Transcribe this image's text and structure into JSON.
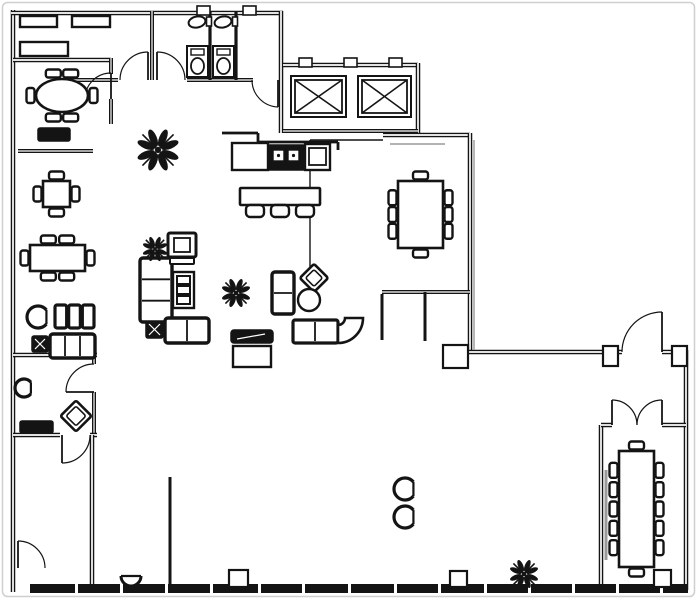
{
  "meta": {
    "title": "Office floor plan drawing",
    "canvas": {
      "w": 697,
      "h": 599
    }
  },
  "palette": {
    "ink": "#141414",
    "paper": "#ffffff",
    "shadow": "#9a9a9a",
    "frame": "#cfcfcf"
  },
  "walls": [
    {
      "pts": [
        [
          13,
          10
        ],
        [
          13,
          592
        ]
      ],
      "t": 4.5,
      "style": "double"
    },
    {
      "pts": [
        [
          11,
          13
        ],
        [
          283,
          13
        ]
      ],
      "t": 4.5,
      "style": "double"
    },
    {
      "pts": [
        [
          152,
          11
        ],
        [
          152,
          80
        ]
      ],
      "t": 4,
      "style": "double"
    },
    {
      "pts": [
        [
          70,
          80
        ],
        [
          118,
          80
        ]
      ],
      "t": 4,
      "style": "double"
    },
    {
      "pts": [
        [
          187,
          80
        ],
        [
          253,
          80
        ]
      ],
      "t": 4,
      "style": "double"
    },
    {
      "pts": [
        [
          281,
          11
        ],
        [
          281,
          133
        ]
      ],
      "t": 4.5,
      "style": "double"
    },
    {
      "pts": [
        [
          210,
          11
        ],
        [
          210,
          80
        ]
      ],
      "t": 3.2,
      "style": "solid"
    },
    {
      "pts": [
        [
          236,
          11
        ],
        [
          236,
          80
        ]
      ],
      "t": 3.2,
      "style": "solid"
    },
    {
      "pts": [
        [
          13,
          60
        ],
        [
          111,
          60
        ]
      ],
      "t": 4.5,
      "style": "double"
    },
    {
      "pts": [
        [
          111,
          58
        ],
        [
          111,
          74
        ]
      ],
      "t": 4,
      "style": "double"
    },
    {
      "pts": [
        [
          111,
          99
        ],
        [
          111,
          124
        ]
      ],
      "t": 4,
      "style": "double"
    },
    {
      "pts": [
        [
          18,
          151
        ],
        [
          93,
          151
        ]
      ],
      "t": 4,
      "style": "double"
    },
    {
      "pts": [
        [
          283,
          65
        ],
        [
          418,
          65
        ]
      ],
      "t": 4.5,
      "style": "double"
    },
    {
      "pts": [
        [
          418,
          63
        ],
        [
          418,
          133
        ]
      ],
      "t": 4.5,
      "style": "double"
    },
    {
      "pts": [
        [
          283,
          131
        ],
        [
          418,
          131
        ]
      ],
      "t": 4,
      "style": "double"
    },
    {
      "pts": [
        [
          222,
          133
        ],
        [
          258,
          133
        ]
      ],
      "t": 2.8,
      "style": "solid"
    },
    {
      "pts": [
        [
          258,
          133
        ],
        [
          258,
          142
        ]
      ],
      "t": 2.8,
      "style": "solid"
    },
    {
      "pts": [
        [
          258,
          142
        ],
        [
          338,
          142
        ]
      ],
      "t": 2.8,
      "style": "solid"
    },
    {
      "pts": [
        [
          338,
          142
        ],
        [
          338,
          150
        ]
      ],
      "t": 2.8,
      "style": "solid"
    },
    {
      "pts": [
        [
          383,
          135
        ],
        [
          470,
          135
        ]
      ],
      "t": 4.5,
      "style": "double"
    },
    {
      "pts": [
        [
          310,
          140
        ],
        [
          383,
          140
        ]
      ],
      "t": 1.4,
      "style": "thin"
    },
    {
      "pts": [
        [
          310,
          140
        ],
        [
          310,
          292
        ]
      ],
      "t": 1.4,
      "style": "thin"
    },
    {
      "pts": [
        [
          470,
          133
        ],
        [
          470,
          352
        ]
      ],
      "t": 4.5,
      "style": "double"
    },
    {
      "pts": [
        [
          382,
          292
        ],
        [
          470,
          292
        ]
      ],
      "t": 4,
      "style": "double"
    },
    {
      "pts": [
        [
          425,
          292
        ],
        [
          425,
          341
        ]
      ],
      "t": 3,
      "style": "solid"
    },
    {
      "pts": [
        [
          382,
          294
        ],
        [
          382,
          340
        ]
      ],
      "t": 3,
      "style": "solid"
    },
    {
      "pts": [
        [
          443,
          352
        ],
        [
          622,
          352
        ]
      ],
      "t": 4.5,
      "style": "double"
    },
    {
      "pts": [
        [
          662,
          352
        ],
        [
          686,
          352
        ]
      ],
      "t": 4.5,
      "style": "double"
    },
    {
      "pts": [
        [
          686,
          350
        ],
        [
          686,
          590
        ]
      ],
      "t": 4.5,
      "style": "double"
    },
    {
      "pts": [
        [
          13,
          355
        ],
        [
          97,
          355
        ]
      ],
      "t": 4.5,
      "style": "double"
    },
    {
      "pts": [
        [
          94,
          355
        ],
        [
          94,
          364
        ]
      ],
      "t": 4,
      "style": "double"
    },
    {
      "pts": [
        [
          94,
          392
        ],
        [
          94,
          435
        ]
      ],
      "t": 4,
      "style": "double"
    },
    {
      "pts": [
        [
          13,
          435
        ],
        [
          60,
          435
        ]
      ],
      "t": 4.5,
      "style": "double"
    },
    {
      "pts": [
        [
          90,
          435
        ],
        [
          97,
          435
        ]
      ],
      "t": 4.5,
      "style": "double"
    },
    {
      "pts": [
        [
          92,
          435
        ],
        [
          92,
          588
        ]
      ],
      "t": 4.5,
      "style": "double"
    },
    {
      "pts": [
        [
          170,
          477
        ],
        [
          170,
          586
        ]
      ],
      "t": 3,
      "style": "solid"
    },
    {
      "pts": [
        [
          601,
          425
        ],
        [
          601,
          586
        ]
      ],
      "t": 4.5,
      "style": "double"
    },
    {
      "pts": [
        [
          601,
          425
        ],
        [
          612,
          425
        ]
      ],
      "t": 4.5,
      "style": "double"
    },
    {
      "pts": [
        [
          662,
          425
        ],
        [
          686,
          425
        ]
      ],
      "t": 4.5,
      "style": "double"
    },
    {
      "pts": [
        [
          474,
          140
        ],
        [
          474,
          350
        ]
      ],
      "t": 1.4,
      "style": "gray"
    },
    {
      "pts": [
        [
          390,
          144
        ],
        [
          445,
          144
        ]
      ],
      "t": 1.4,
      "style": "gray"
    },
    {
      "pts": [
        [
          606,
          470
        ],
        [
          606,
          560
        ]
      ],
      "t": 3,
      "style": "gray"
    }
  ],
  "doors": [
    {
      "name": "vestibule-door-left",
      "hinge": [
        148,
        80
      ],
      "tip": [
        148,
        52
      ],
      "end": [
        120,
        80
      ],
      "sweep": 0
    },
    {
      "name": "vestibule-door-right",
      "hinge": [
        157,
        80
      ],
      "tip": [
        157,
        52
      ],
      "end": [
        185,
        80
      ],
      "sweep": 1
    },
    {
      "name": "corridor-door",
      "hinge": [
        278,
        80
      ],
      "tip": [
        278,
        107
      ],
      "end": [
        252,
        80
      ],
      "sweep": 1
    },
    {
      "name": "meeting-room-door",
      "hinge": [
        111,
        99
      ],
      "tip": [
        111,
        73
      ],
      "end": [
        85,
        99
      ],
      "sweep": 0
    },
    {
      "name": "office-door",
      "hinge": [
        94,
        392
      ],
      "tip": [
        66,
        392
      ],
      "end": [
        94,
        364
      ],
      "sweep": 1
    },
    {
      "name": "stairwell-door",
      "hinge": [
        62,
        435
      ],
      "tip": [
        62,
        463
      ],
      "end": [
        90,
        435
      ],
      "sweep": 0
    },
    {
      "name": "stair-exit-door",
      "hinge": [
        18,
        568
      ],
      "tip": [
        18,
        541
      ],
      "end": [
        45,
        568
      ],
      "sweep": 1
    },
    {
      "name": "entry-door-right",
      "hinge": [
        662,
        352
      ],
      "tip": [
        662,
        312
      ],
      "end": [
        622,
        352
      ],
      "sweep": 0
    },
    {
      "name": "boardroom-door-left",
      "hinge": [
        612,
        425
      ],
      "tip": [
        612,
        400
      ],
      "end": [
        637,
        425
      ],
      "sweep": 1
    },
    {
      "name": "boardroom-door-right",
      "hinge": [
        662,
        425
      ],
      "tip": [
        662,
        400
      ],
      "end": [
        637,
        425
      ],
      "sweep": 0
    }
  ],
  "columns": [
    [
      443,
      345,
      25,
      23
    ],
    [
      603,
      346,
      15,
      20
    ],
    [
      672,
      346,
      15,
      20
    ],
    [
      229,
      570,
      19,
      17
    ],
    [
      450,
      571,
      17,
      16
    ],
    [
      654,
      570,
      17,
      17
    ]
  ],
  "wall_ticks": [
    [
      197,
      6,
      13,
      9
    ],
    [
      243,
      6,
      13,
      9
    ],
    [
      299,
      58,
      13,
      9
    ],
    [
      344,
      58,
      13,
      9
    ],
    [
      389,
      58,
      13,
      9
    ]
  ],
  "bottom_band": {
    "x1": 30,
    "x2": 688,
    "y": 584,
    "h": 9,
    "ticks": [
      75,
      120,
      165,
      210,
      258,
      302,
      348,
      394,
      438,
      484,
      528,
      572,
      616,
      660
    ]
  },
  "furniture": {
    "cabinets": [
      [
        20,
        16,
        37,
        11
      ],
      [
        72,
        16,
        38,
        11
      ],
      [
        20,
        42,
        48,
        14
      ],
      [
        233,
        346,
        38,
        21
      ]
    ],
    "credenzas": [
      [
        38,
        128,
        32,
        13
      ],
      [
        20,
        421,
        33,
        12
      ]
    ],
    "tv_console": [
      231,
      330,
      42,
      13
    ],
    "x_tables": [
      [
        146,
        321,
        17,
        17
      ],
      [
        32,
        336,
        16,
        16
      ]
    ],
    "tables": [
      {
        "name": "oval-meeting-table",
        "shape": "oval",
        "x": 36,
        "y": 79,
        "w": 52,
        "h": 33,
        "chairs": {
          "top": 2,
          "bottom": 2,
          "left": 1,
          "right": 1
        }
      },
      {
        "name": "cafe-table",
        "shape": "rect",
        "x": 43,
        "y": 181,
        "w": 27,
        "h": 26,
        "chairs": {
          "top": 1,
          "bottom": 1,
          "left": 1,
          "right": 1
        }
      },
      {
        "name": "dining-table",
        "shape": "rect",
        "x": 30,
        "y": 245,
        "w": 55,
        "h": 26,
        "chairs": {
          "top": 2,
          "bottom": 2,
          "left": 1,
          "right": 1
        }
      },
      {
        "name": "conference-table-8",
        "shape": "rect",
        "x": 398,
        "y": 181,
        "w": 45,
        "h": 67,
        "chairs": {
          "top": 1,
          "bottom": 1,
          "left": 3,
          "right": 3
        }
      },
      {
        "name": "boardroom-table-12",
        "shape": "rect",
        "x": 619,
        "y": 451,
        "w": 35,
        "h": 116,
        "chairs": {
          "top": 1,
          "bottom": 1,
          "left": 5,
          "right": 5
        }
      }
    ],
    "sofas": [
      {
        "x": 140,
        "y": 258,
        "w": 32,
        "h": 64,
        "seats": 3,
        "vert": true
      },
      {
        "x": 165,
        "y": 318,
        "w": 44,
        "h": 25,
        "seats": 2,
        "vert": false
      },
      {
        "x": 272,
        "y": 272,
        "w": 22,
        "h": 42,
        "seats": 2,
        "vert": true
      },
      {
        "x": 50,
        "y": 334,
        "w": 45,
        "h": 24,
        "seats": 3,
        "vert": false
      }
    ],
    "bench3": {
      "x": 55,
      "y": 305,
      "w": 38,
      "h": 23
    },
    "armchair": {
      "x": 168,
      "y": 233,
      "w": 28,
      "h": 30
    },
    "tub_chairs": [
      {
        "cx": 38,
        "cy": 317,
        "r": 11
      },
      {
        "cx": 24,
        "cy": 388,
        "r": 9
      },
      {
        "cx": 405,
        "cy": 489,
        "r": 11
      },
      {
        "cx": 405,
        "cy": 517,
        "r": 11
      }
    ],
    "semi_chair": {
      "cx": 131,
      "cy": 576,
      "r": 10
    },
    "shelf3": {
      "x": 173,
      "y": 272,
      "w": 21,
      "h": 36
    },
    "diamond_chairs": [
      {
        "cx": 314,
        "cy": 278,
        "s": 20
      },
      {
        "cx": 76,
        "cy": 416,
        "s": 22
      }
    ],
    "round_table": {
      "cx": 309,
      "cy": 300,
      "r": 11
    },
    "sectional": {
      "x": 293,
      "y": 320
    },
    "plants": [
      {
        "cx": 158,
        "cy": 150,
        "r": 22
      },
      {
        "cx": 155,
        "cy": 249,
        "r": 13
      },
      {
        "cx": 236,
        "cy": 293,
        "r": 15
      },
      {
        "cx": 524,
        "cy": 574,
        "r": 15
      }
    ],
    "kitchen": {
      "x": 232,
      "y": 143
    },
    "bar": {
      "x": 240,
      "y": 188,
      "w": 80,
      "h": 17,
      "stools": 3
    },
    "elevators": [
      {
        "x": 291,
        "y": 76,
        "w": 55,
        "h": 41
      },
      {
        "x": 358,
        "y": 76,
        "w": 53,
        "h": 41
      }
    ],
    "toilets": [
      {
        "x": 187,
        "y": 46
      },
      {
        "x": 213,
        "y": 46
      }
    ],
    "sinks": [
      {
        "x": 189,
        "y": 16
      },
      {
        "x": 215,
        "y": 16
      }
    ],
    "stairs": {
      "x": 24,
      "y": 452
    },
    "workstations": [
      {
        "x": 192,
        "y": 437,
        "h": 45,
        "side": "left"
      },
      {
        "x": 253,
        "y": 437,
        "h": 45,
        "side": "left"
      },
      {
        "x": 279,
        "y": 437,
        "h": 45,
        "side": "right"
      },
      {
        "x": 341,
        "y": 437,
        "h": 45,
        "side": "right"
      },
      {
        "x": 192,
        "y": 522,
        "h": 51,
        "side": "left"
      },
      {
        "x": 253,
        "y": 522,
        "h": 51,
        "side": "left"
      },
      {
        "x": 280,
        "y": 522,
        "h": 51,
        "side": "right"
      },
      {
        "x": 341,
        "y": 522,
        "h": 51,
        "side": "right"
      }
    ],
    "cloud_chairs": [
      {
        "cx": 402,
        "cy": 313
      },
      {
        "cx": 445,
        "cy": 313
      }
    ],
    "meeting_desk": {
      "x": 420,
      "y": 473
    },
    "u_desk": {
      "x": 472,
      "y": 470
    },
    "square_stools": [
      [
        490,
        452,
        17,
        16
      ],
      [
        513,
        452,
        17,
        16
      ]
    ],
    "side_chairs": [
      [
        562,
        490,
        26,
        22
      ],
      [
        562,
        515,
        26,
        22
      ]
    ],
    "settee": {
      "x": 95,
      "y": 496
    },
    "leaf_plant": {
      "x": 153,
      "y": 496
    },
    "small_desk": {
      "x": 112,
      "y": 553,
      "w": 40,
      "h": 22
    }
  }
}
